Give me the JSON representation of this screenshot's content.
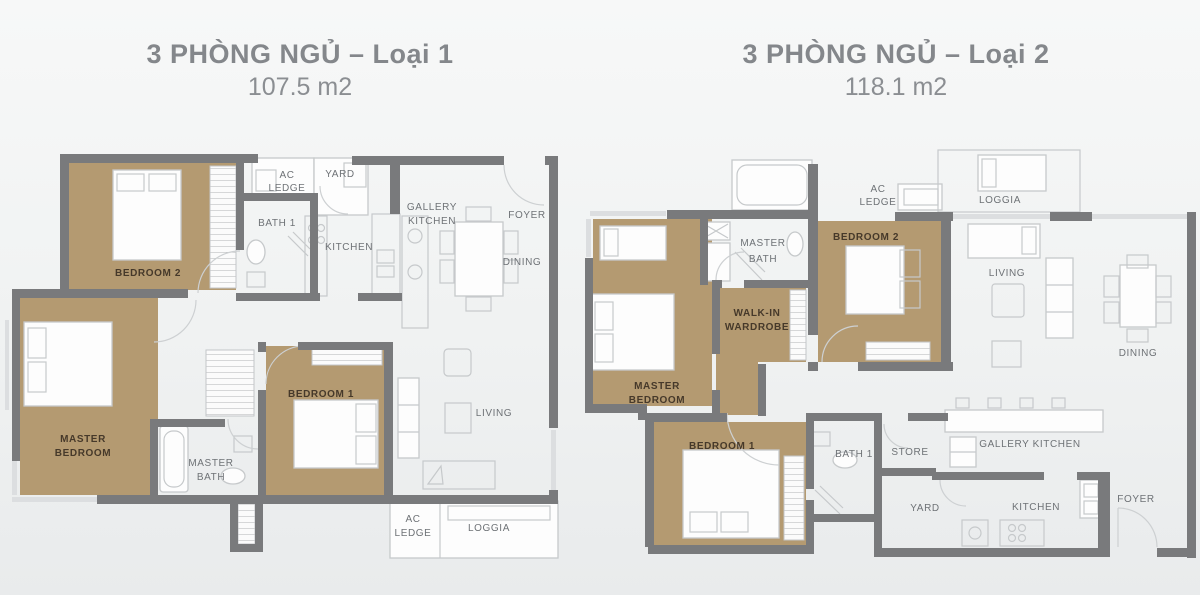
{
  "plans": [
    {
      "title": "3 PHÒNG NGỦ – Loại 1",
      "area": "107.5 m2",
      "rooms": {
        "bedroom2": "BEDROOM 2",
        "ac_ledge_top": [
          "AC",
          "LEDGE"
        ],
        "yard": "YARD",
        "bath1": "BATH 1",
        "kitchen": "KITCHEN",
        "gallery_kitchen": [
          "GALLERY",
          "KITCHEN"
        ],
        "foyer": "FOYER",
        "dining": "DINING",
        "living": "LIVING",
        "master_bedroom": [
          "MASTER",
          "BEDROOM"
        ],
        "master_bath": [
          "MASTER",
          "BATH"
        ],
        "bedroom1": "BEDROOM 1",
        "ac_ledge_bottom": [
          "AC",
          "LEDGE"
        ],
        "loggia": "LOGGIA"
      }
    },
    {
      "title": "3 PHÒNG NGỦ – Loại 2",
      "area": "118.1 m2",
      "rooms": {
        "master_bath": [
          "MASTER",
          "BATH"
        ],
        "ac_ledge": [
          "AC",
          "LEDGE"
        ],
        "loggia": "LOGGIA",
        "bedroom2": "BEDROOM 2",
        "walkin_wardrobe": [
          "WALK-IN",
          "WARDROBE"
        ],
        "master_bedroom": [
          "MASTER",
          "BEDROOM"
        ],
        "living": "LIVING",
        "dining": "DINING",
        "bedroom1": "BEDROOM 1",
        "bath1": "BATH 1",
        "store": "STORE",
        "gallery_kitchen": "GALLERY KITCHEN",
        "yard": "YARD",
        "kitchen": "KITCHEN",
        "foyer": "FOYER"
      }
    }
  ],
  "colors": {
    "wall": "#797a7c",
    "room_tan": "#b49a71",
    "label_dark": "#46392a",
    "label_gray": "#6e7276",
    "title_gray": "#84878b",
    "background": "#f0f2f2",
    "furniture_line": "#c6c9cb"
  }
}
